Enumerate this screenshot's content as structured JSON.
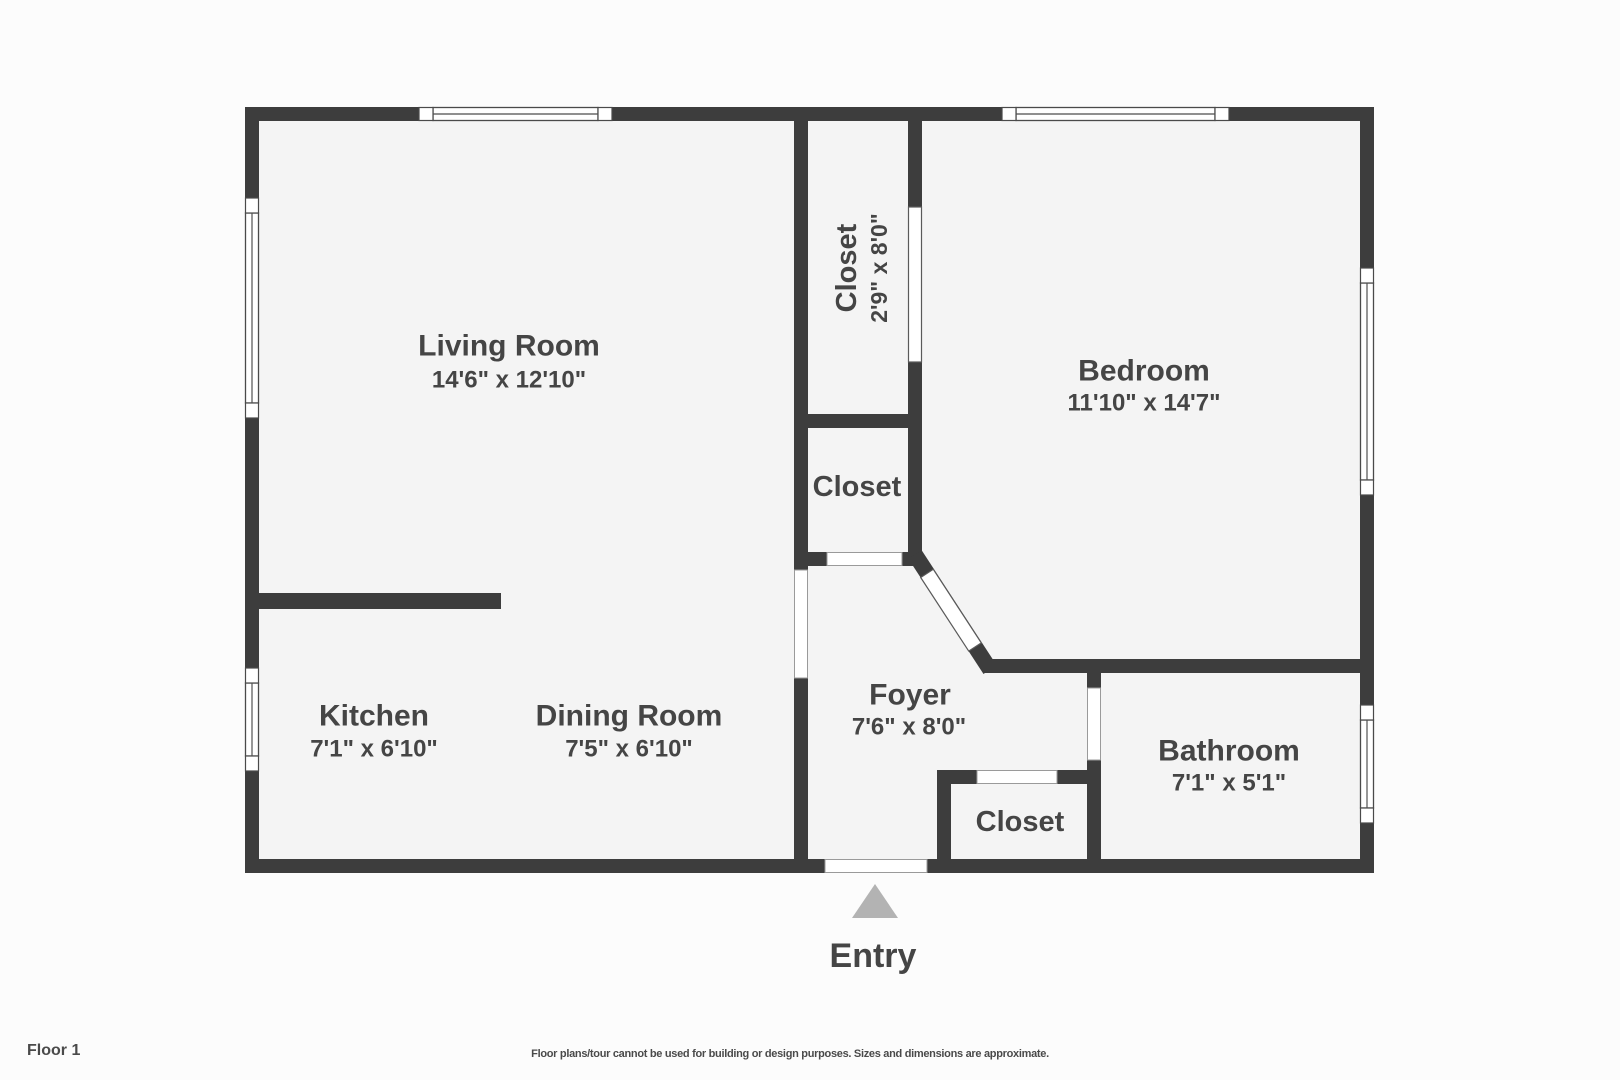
{
  "floor_plan": {
    "floor_label": "Floor 1",
    "entry": {
      "label": "Entry",
      "icon": "entry-arrow-icon"
    },
    "rooms": {
      "living_room": {
        "name": "Living Room",
        "dimensions": "14'6\" x 12'10\""
      },
      "bedroom": {
        "name": "Bedroom",
        "dimensions": "11'10\" x 14'7\""
      },
      "kitchen": {
        "name": "Kitchen",
        "dimensions": "7'1\" x 6'10\""
      },
      "dining_room": {
        "name": "Dining Room",
        "dimensions": "7'5\" x 6'10\""
      },
      "foyer": {
        "name": "Foyer",
        "dimensions": "7'6\" x 8'0\""
      },
      "bathroom": {
        "name": "Bathroom",
        "dimensions": "7'1\" x 5'1\""
      },
      "bedroom_closet": {
        "name": "Closet",
        "dimensions": "2'9\" x 8'0\""
      },
      "hall_closet": {
        "name": "Closet"
      },
      "entry_closet": {
        "name": "Closet"
      }
    }
  },
  "footer": {
    "disclaimer": "Floor plans/tour cannot be used for building or design purposes. Sizes and dimensions are approximate."
  },
  "colors": {
    "wall": "#3d3d3d",
    "room_fill": "#f4f4f4",
    "page_background": "#fcfcfc",
    "label_text": "#454545",
    "entry_arrow": "#b3b3b3",
    "opening_outline": "#9a9a9a"
  }
}
